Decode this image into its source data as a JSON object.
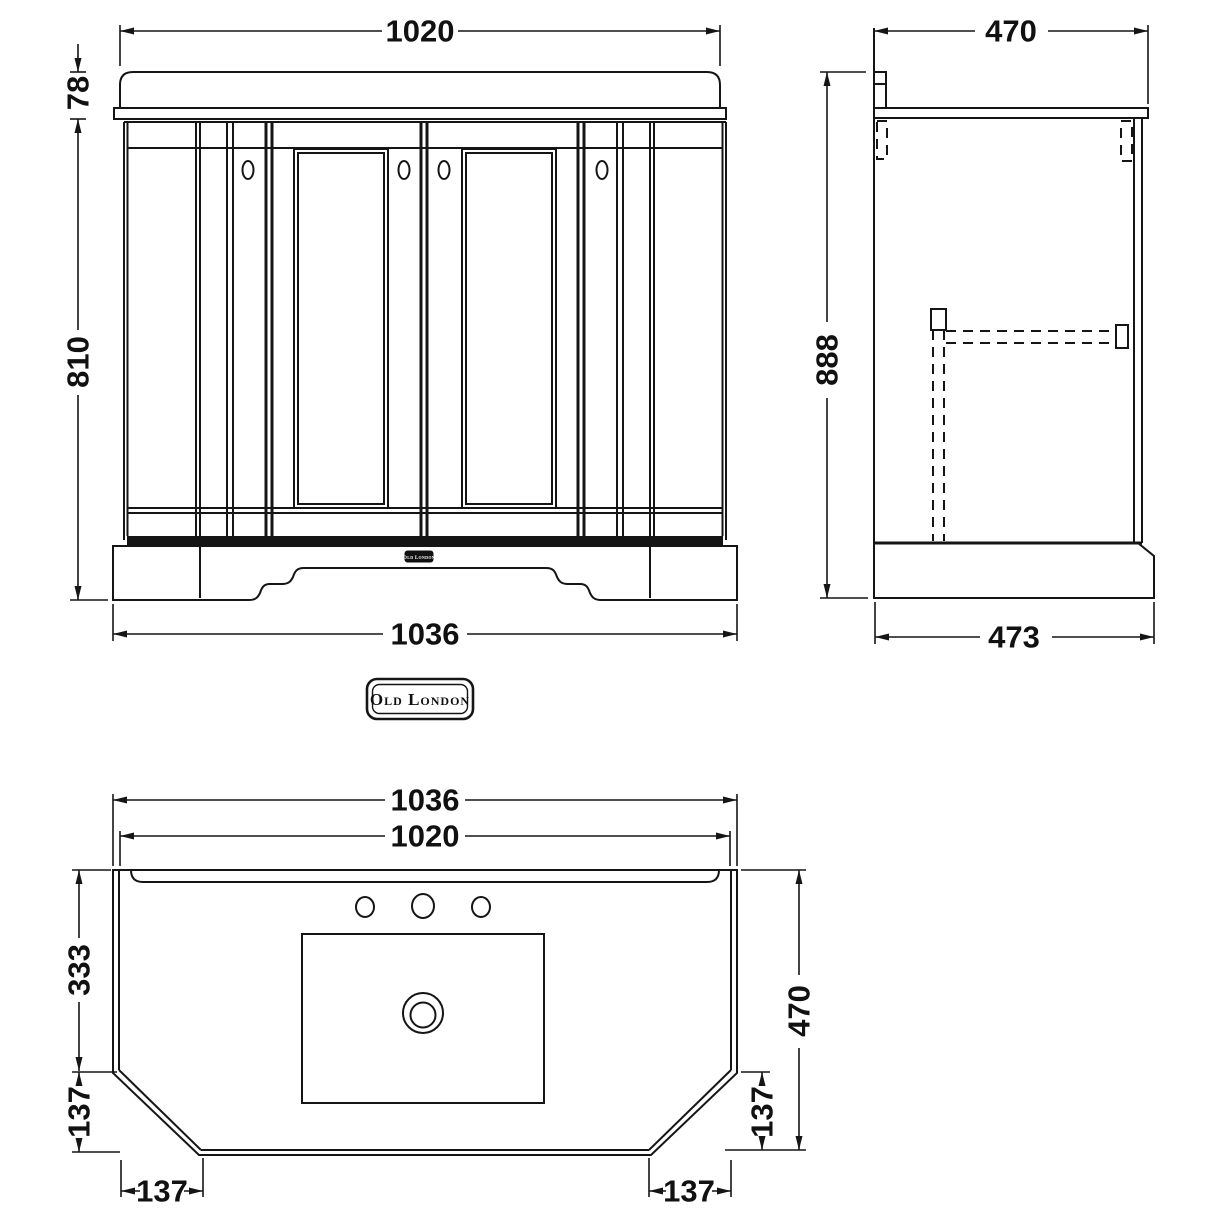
{
  "drawing": {
    "brand_badge": "Old London",
    "plinth_badge": "Old London"
  },
  "dimensions": {
    "front": {
      "top_width": "1020",
      "counter_height": "78",
      "body_height": "810",
      "base_width": "1036"
    },
    "side": {
      "depth": "470",
      "height": "888",
      "base_depth": "473"
    },
    "plan": {
      "overall_width": "1036",
      "top_width": "1020",
      "back_to_chamfer": "333",
      "chamfer_side_left": "137",
      "chamfer_side_right": "137",
      "depth": "470",
      "chamfer_bottom_left": "137",
      "chamfer_bottom_right": "137"
    }
  }
}
